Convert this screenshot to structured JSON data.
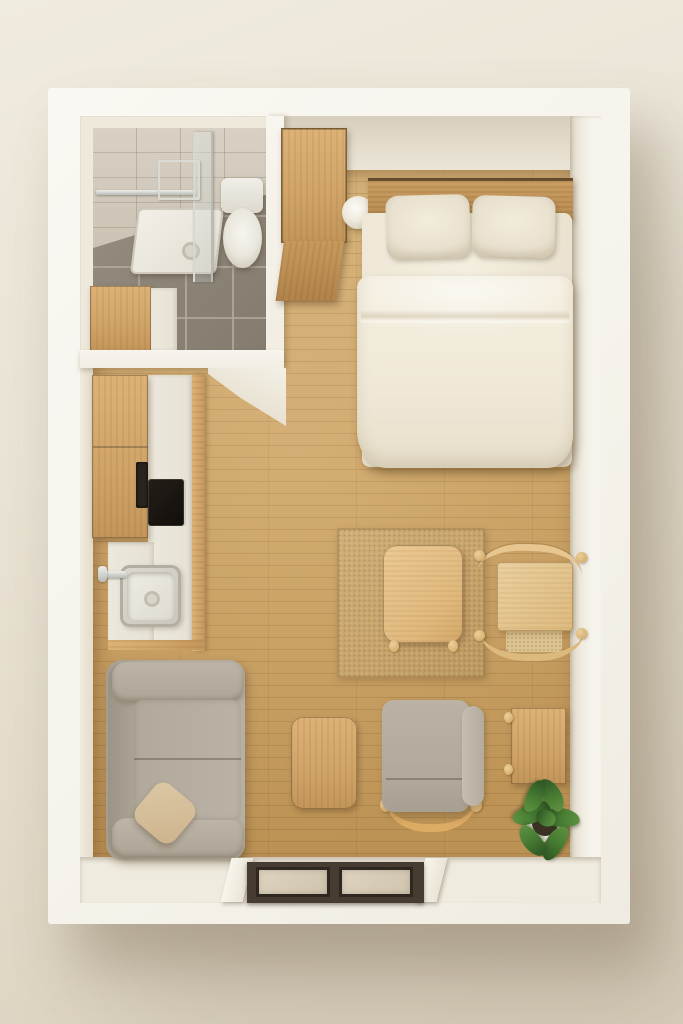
{
  "meta": {
    "scene_type": "3d-floorplan-top-down-render",
    "description": "Photorealistic top-down 3D render of a compact studio apartment with white walls, light oak flooring and minimalist wood furniture",
    "canvas": {
      "width": 683,
      "height": 1024
    },
    "visible_text": "none"
  },
  "labels": {
    "scene": "Top-down 3D floor plan of a studio apartment",
    "building": "Studio apartment unit",
    "bathroom": "Bathroom with gray tile floor",
    "shower": "Glass walk-in shower with white tray",
    "toilet": "Toilet",
    "vanity": "Bathroom vanity cabinet with white counter",
    "wardrobe": "Tall wooden wardrobe cabinet",
    "bed": "Double bed with cream bedding",
    "pillow_left": "Left pillow",
    "pillow_right": "Right pillow",
    "duvet": "Cream duvet",
    "round_side_table": "Round white bedside table",
    "kitchen": "Kitchenette with wood cabinets",
    "cooktop": "Built-in black cooktop",
    "sink": "Kitchen sink with faucet",
    "rug": "Square woven jute rug",
    "dining_table": "Square wooden dining table",
    "dining_chair": "Wooden spindle-back dining chair",
    "sofa": "Two-seat taupe fabric sofa",
    "throw_pillow": "Beige throw pillow",
    "coffee_table": "Small wooden coffee table",
    "lounge_chair": "Gray upholstered lounge chair with wood frame",
    "side_table": "Low wooden side table",
    "plant": "Green potted plant",
    "entry": "Entryway with dark-framed double doormats",
    "doormat_left": "Left doormat",
    "doormat_right": "Right doormat"
  },
  "palette": {
    "background": "#eae4d7",
    "background_shadow": "#d8cebb",
    "wall_white": "#f6f3ec",
    "wall_face_shadow": "#ddd5c4",
    "floor_wood": "#c89f63",
    "floor_seam": "#6e4b23",
    "bath_tile_floor": "#8a8275",
    "bath_tile_wall": "#cfc8ba",
    "wood_furniture": "#d0a468",
    "wood_light": "#e0b87d",
    "bedding_cream": "#f1ebdc",
    "pillow_beige": "#e9e1cf",
    "fabric_taupe": "#b3ab9e",
    "throw_pillow_tan": "#d5c19e",
    "rug_tan": "#c5a26a",
    "plant_green": "#477c33",
    "entry_frame_dark": "#463c31",
    "doormat_beige": "#d6cbb6",
    "chrome": "#c3c6bf",
    "cooktop_black": "#1a1510"
  },
  "rooms": [
    {
      "name": "bathroom",
      "position": "top-left",
      "items": [
        "shower",
        "toilet",
        "vanity"
      ]
    },
    {
      "name": "sleeping-area",
      "position": "top-right",
      "items": [
        "wardrobe",
        "round_side_table",
        "bed"
      ]
    },
    {
      "name": "kitchenette",
      "position": "left-middle",
      "items": [
        "upper-cabinet",
        "counter",
        "cooktop",
        "sink"
      ]
    },
    {
      "name": "living-area",
      "position": "center-bottom",
      "items": [
        "rug",
        "dining_table",
        "dining_chair",
        "sofa",
        "coffee_table",
        "lounge_chair",
        "side_table",
        "plant"
      ]
    },
    {
      "name": "entryway",
      "position": "bottom",
      "items": [
        "doormat_left",
        "doormat_right"
      ]
    }
  ]
}
